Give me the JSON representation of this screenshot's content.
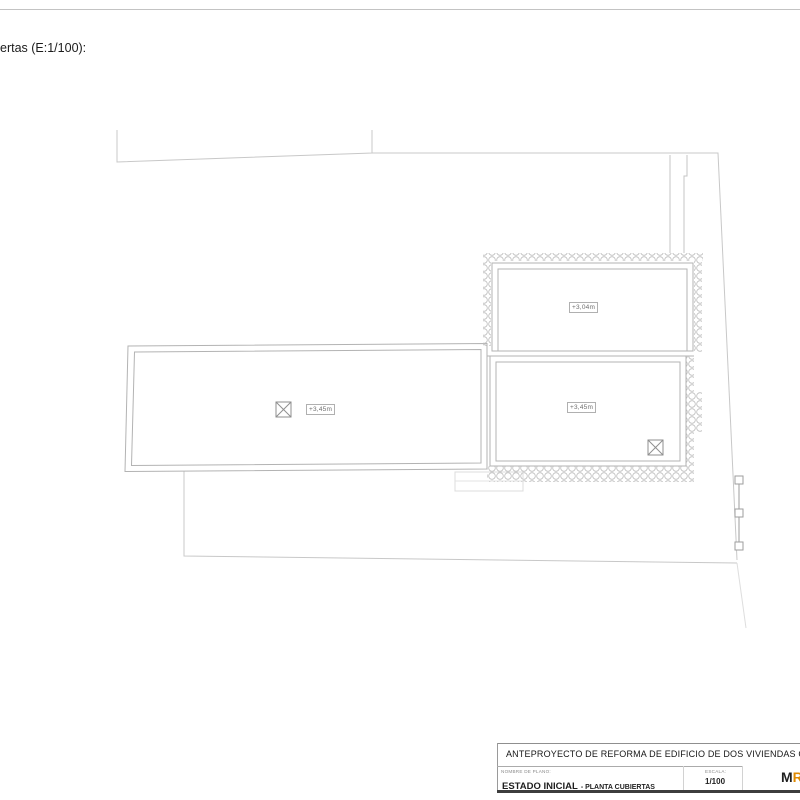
{
  "page": {
    "plan_label": "ertas (E:1/100):"
  },
  "drawing": {
    "labels": {
      "roof_upper_right_elevation": "+3,04m",
      "roof_left_elevation": "+3,45m",
      "roof_lower_right_elevation": "+3,45m"
    }
  },
  "title_block": {
    "project_title": "ANTEPROYECTO DE REFORMA DE EDIFICIO DE DOS VIVIENDAS CON AMP",
    "plan_name_label": "NOMBRE DE PLANO:",
    "plan_name": "ESTADO INICIAL",
    "plan_name_suffix": "- PLANTA CUBIERTAS",
    "scale_label": "ESCALA:",
    "scale_value": "1/100",
    "logo_black": "M",
    "logo_orange": "R"
  },
  "colors": {
    "accent_orange": "#e08a00",
    "line_gray": "#bdbdbd",
    "boundary_gray": "#c8c8c8",
    "dark_line": "#3d3d3d"
  }
}
